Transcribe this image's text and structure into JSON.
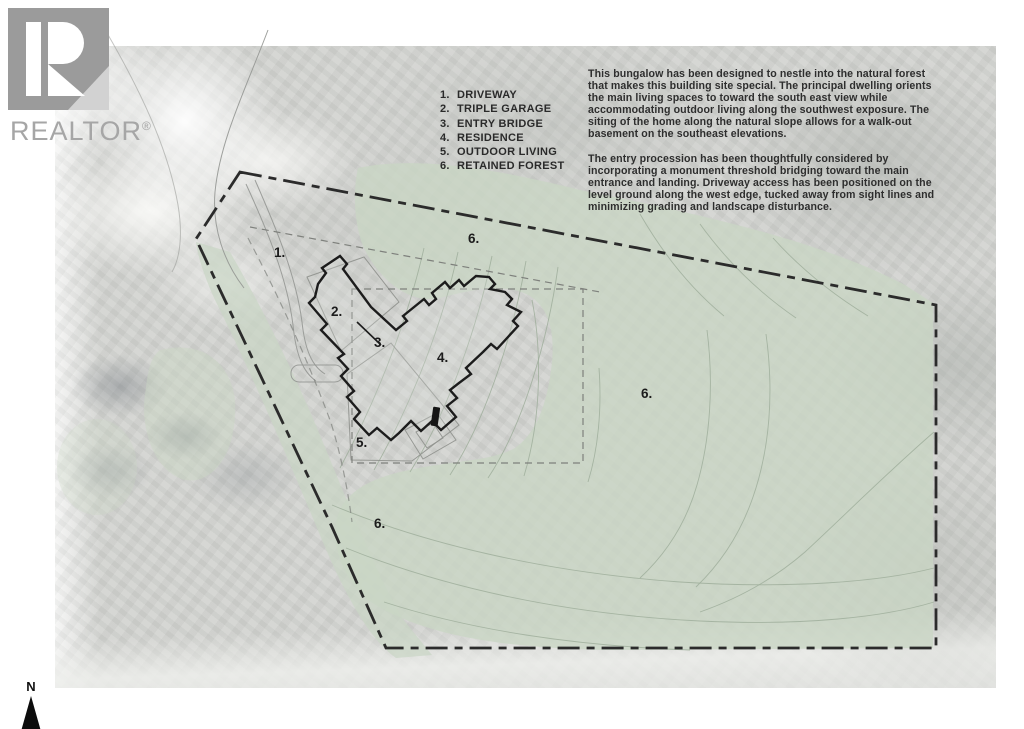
{
  "logo": {
    "brand": "REALTOR",
    "reg": "®"
  },
  "legend": {
    "items": [
      {
        "num": "1.",
        "label": "DRIVEWAY"
      },
      {
        "num": "2.",
        "label": "TRIPLE GARAGE"
      },
      {
        "num": "3.",
        "label": "ENTRY BRIDGE"
      },
      {
        "num": "4.",
        "label": "RESIDENCE"
      },
      {
        "num": "5.",
        "label": "OUTDOOR LIVING"
      },
      {
        "num": "6.",
        "label": "RETAINED FOREST"
      }
    ]
  },
  "description": {
    "p1": "This bungalow has been designed to nestle into the natural forest that makes this building site special.  The principal dwelling orients the main living spaces to toward the south east view while accommodating outdoor living along the southwest exposure.  The siting of the home along the natural slope allows for a walk-out basement on the southeast elevations.",
    "p2": "The entry procession has been thoughtfully considered by incorporating a monument threshold bridging toward the main entrance and landing. Driveway access has been positioned on the level ground along the west edge, tucked away from sight lines and minimizing grading and landscape disturbance."
  },
  "plan": {
    "labels": [
      {
        "text": "1."
      },
      {
        "text": "2."
      },
      {
        "text": "3."
      },
      {
        "text": "4."
      },
      {
        "text": "5."
      },
      {
        "text": "6."
      },
      {
        "text": "6."
      },
      {
        "text": "6."
      }
    ],
    "colors": {
      "forest_overlay": "#c9d6c4",
      "boundary_line": "#2b2b2b",
      "building_outline": "#1c1c1c",
      "contour_line": "#9fae9b",
      "photo_gray": "#d2d3d0"
    }
  },
  "north": {
    "label": "N"
  }
}
